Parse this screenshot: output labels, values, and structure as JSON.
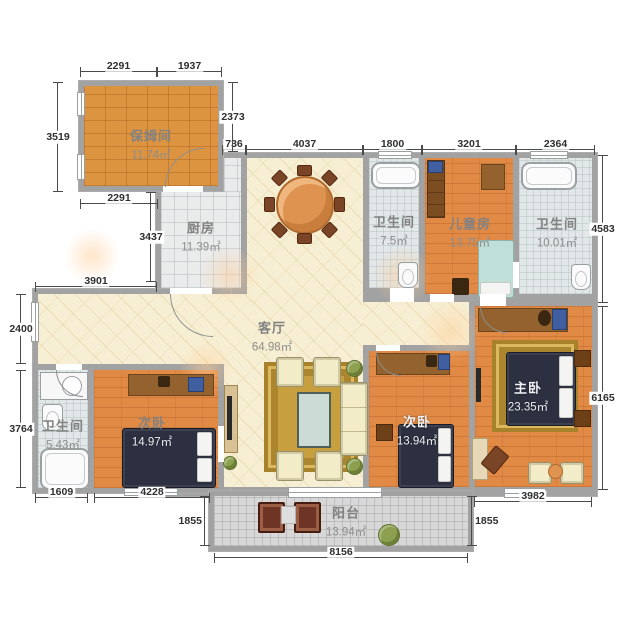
{
  "plan_title": "apartment-floor-plan",
  "rooms": {
    "nanny": {
      "name": "保姆间",
      "area": "11.74㎡"
    },
    "kitchen": {
      "name": "厨房",
      "area": "11.39㎡"
    },
    "bath_a": {
      "name": "卫生间",
      "area": "7.5㎡"
    },
    "children": {
      "name": "儿童房",
      "area": "13.75㎡"
    },
    "bath_b": {
      "name": "卫生间",
      "area": "10.01㎡"
    },
    "living": {
      "name": "客厅",
      "area": "64.98㎡"
    },
    "bath_c": {
      "name": "卫生间",
      "area": "5.43㎡"
    },
    "bedroom_a": {
      "name": "次卧",
      "area": "14.97㎡"
    },
    "bedroom_b": {
      "name": "次卧",
      "area": "13.94㎡"
    },
    "master": {
      "name": "主卧",
      "area": "23.35㎡"
    },
    "balcony": {
      "name": "阳台",
      "area": "13.94㎡"
    }
  },
  "dimensions_mm": {
    "nanny_top_left": "2291",
    "nanny_top_right": "1937",
    "nanny_left": "3519",
    "nanny_bottom": "2291",
    "nanny_right": "2373",
    "kitchen_top": "736",
    "living_top": "4037",
    "bath_a_top": "1800",
    "children_top": "3201",
    "bath_b_top": "2364",
    "right_upper": "4583",
    "right_lower": "6165",
    "kitchen_left": "3437",
    "hallway_top": "3901",
    "hallway_left": "2400",
    "bath_c_left": "3764",
    "bath_c_bottom": "1609",
    "bedroom_a_bottom": "4228",
    "balcony_left": "1855",
    "balcony_bottom": "8156",
    "balcony_right": "1855",
    "master_bottom": "3982"
  },
  "colors": {
    "wall": "#a2a2a2",
    "wood_floor": "#e18a45",
    "parquet_floor": "#dd9440",
    "living_floor": "#f7efd4",
    "bath_floor": "#e2e7e8",
    "balcony_floor": "#d8d8d8",
    "bed": "#2c3040",
    "rug": "#c79f3e",
    "dimension_text": "#2f2f2f",
    "label_text": "#828282"
  }
}
